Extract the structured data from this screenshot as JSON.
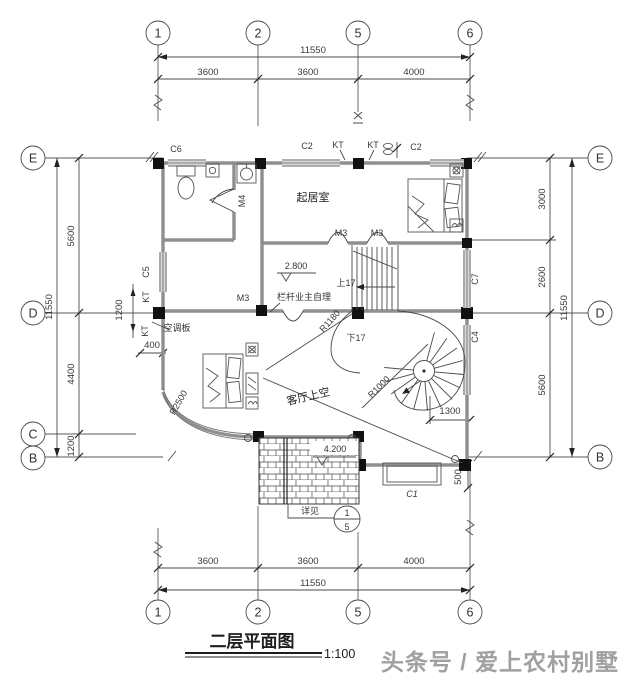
{
  "title": {
    "text": "二层平面图",
    "scale": "1:100"
  },
  "watermark": "头条号 / 爱上农村别墅",
  "axes": {
    "top": [
      "1",
      "2",
      "5",
      "6"
    ],
    "bottom": [
      "1",
      "2",
      "5",
      "6"
    ],
    "left": [
      "E",
      "D",
      "C",
      "B"
    ],
    "right": [
      "E",
      "D",
      "B"
    ]
  },
  "dims": {
    "top": {
      "total": "11550",
      "segs": [
        "3600",
        "3600",
        "4000"
      ]
    },
    "bottom": {
      "total": "11550",
      "segs": [
        "3600",
        "3600",
        "4000"
      ]
    },
    "left": {
      "total": "11550",
      "segs": [
        "5600",
        "4400",
        "1200"
      ]
    },
    "right": {
      "total": "11550",
      "segs": [
        "3000",
        "2600",
        "5600"
      ]
    },
    "inner": {
      "d1200": "1200",
      "d400": "400",
      "d1300": "1300",
      "d500": "500"
    }
  },
  "openings": {
    "c1": "C1",
    "c2a": "C2",
    "c2b": "C2",
    "c4": "C4",
    "c5": "C5",
    "c6": "C6",
    "c7": "C7",
    "m3a": "M3",
    "m3b": "M3",
    "m3c": "M3",
    "m4": "M4",
    "kt1": "KT",
    "kt2": "KT",
    "kt3": "KT",
    "kt4": "KT"
  },
  "rooms": {
    "living": "起居室",
    "void": "客厅上空",
    "ac_slab": "空调板"
  },
  "levels": {
    "floor": "2.800",
    "roof": "4.200"
  },
  "stair": {
    "up": "上17",
    "down": "下17",
    "r1": "R1180",
    "r2": "R1000",
    "r3": "R2500"
  },
  "notes": {
    "railing": "栏杆业主自理",
    "detail": "详见",
    "detail_no": "1",
    "detail_sheet": "5"
  }
}
